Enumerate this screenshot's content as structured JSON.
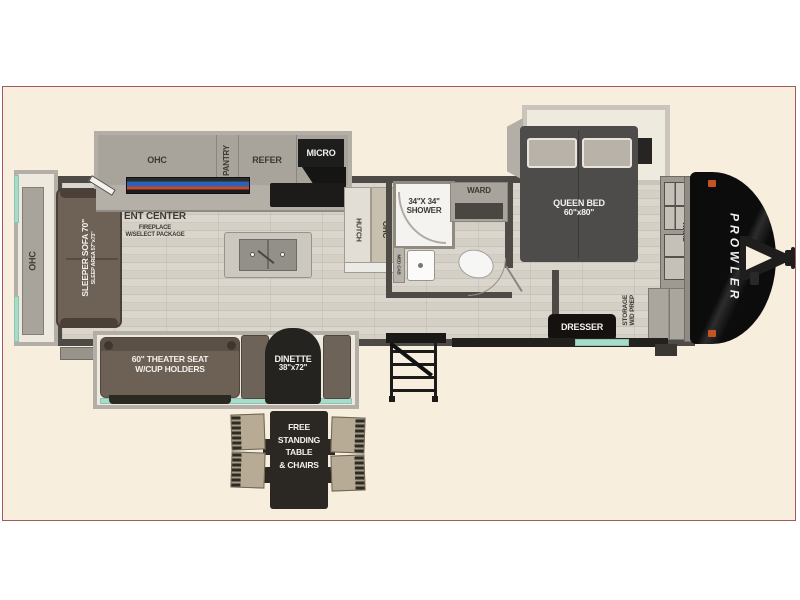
{
  "colors": {
    "page_bg": "#ffffff",
    "panel_bg": "#f7eedd",
    "panel_border": "#a3595f",
    "wall": "#4e4a45",
    "teal_accent": "#a7dcca",
    "front_cap": "#121212",
    "brand_text": "#f0f0f0"
  },
  "plan": {
    "rear_slide": {
      "ohc": "OHC"
    },
    "living": {
      "sofa_title": "SLEEPER SOFA 70\"",
      "sofa_sub": "SLEEP AREA 57\"x73\"",
      "ent_center": "ENT CENTER",
      "fireplace_line1": "FIREPLACE",
      "fireplace_line2": "W/SELECT PACKAGE"
    },
    "kitchen": {
      "ohc": "OHC",
      "pantry": "PANTRY",
      "refer": "REFER",
      "micro": "MICRO",
      "hutch": "HUTCH",
      "hutch_ohc": "OHC"
    },
    "bath": {
      "shower_line1": "34\"X 34\"",
      "shower_line2": "SHOWER",
      "med_cab": "MED CAB",
      "ward": "WARD"
    },
    "bedroom": {
      "bed_line1": "QUEEN BED",
      "bed_line2": "60\"x80\"",
      "ward": "WARD",
      "storage_line1": "STORAGE",
      "storage_line2": "W/D PREP",
      "dresser": "DRESSER"
    },
    "slide_bottom": {
      "theater_line1": "60\" THEATER SEAT",
      "theater_line2": "W/CUP HOLDERS",
      "dinette_line1": "DINETTE",
      "dinette_line2": "38\"x72\""
    },
    "exterior": {
      "brand": "PROWLER",
      "table_line1": "FREE",
      "table_line2": "STANDING",
      "table_line3": "TABLE",
      "table_line4": "& CHAIRS"
    }
  }
}
